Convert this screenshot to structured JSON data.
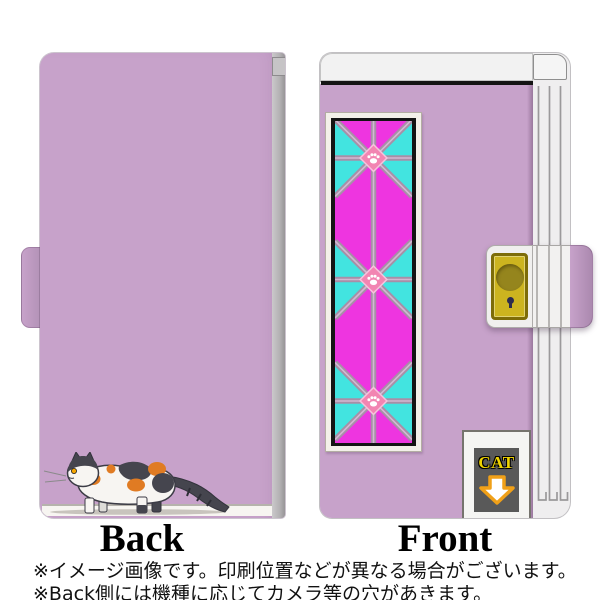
{
  "labels": {
    "back": "Back",
    "front": "Front"
  },
  "badge": {
    "text": "CAT"
  },
  "notes": {
    "line1": "※イメージ画像です。印刷位置などが異なる場合がございます。",
    "line2": "※Back側には機種に応じてカメラ等の穴があきます。"
  },
  "icons": [
    "paw-print-icon",
    "arrow-down-icon",
    "keyhole-icon",
    "calico-cat-illustration"
  ],
  "colors": {
    "lilac": "#c7a2ca",
    "lilac_dark": "#a987ad",
    "magenta": "#ee35e0",
    "cyan": "#42e4e0",
    "lattice": "#a78fa7",
    "lattice_hi": "#d2b9d2",
    "paw_pink": "#f285b2",
    "gold": "#ccb41f",
    "gold_dark": "#7d6c08",
    "gold_circle": "#95851d",
    "panel_gray": "#595959",
    "badge_yellow": "#f0d400",
    "arrow_orange": "#f0a018",
    "cat_orange": "#e07b23",
    "cat_dark": "#45454e",
    "spine_white": "#efeeef",
    "bar_white": "#f2f2f2",
    "frame_black": "#141414",
    "text_black": "#111111"
  }
}
